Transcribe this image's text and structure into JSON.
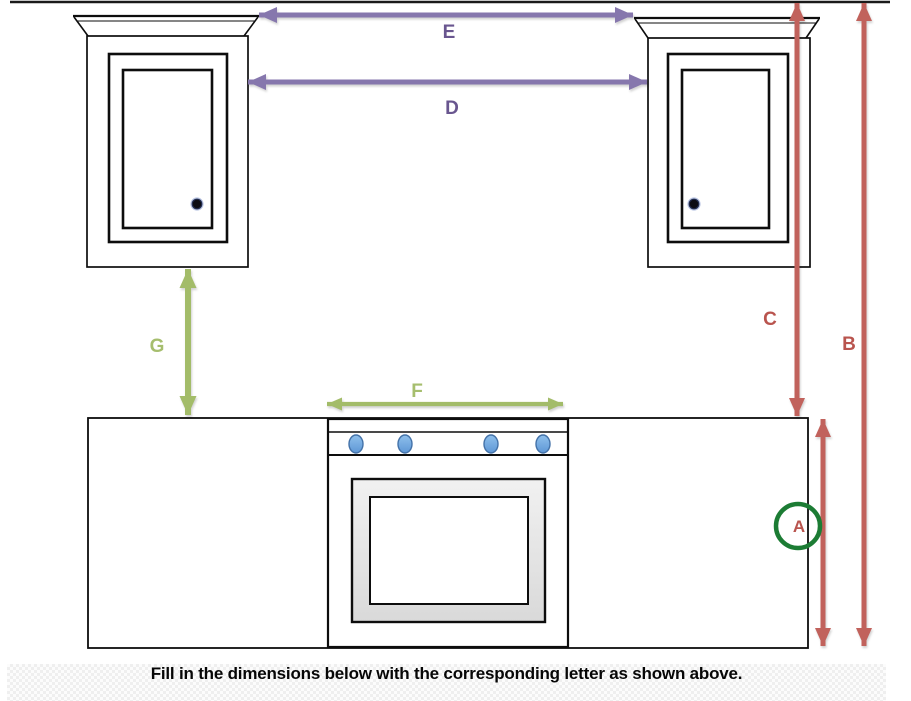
{
  "labels": {
    "a": "A",
    "b": "B",
    "c": "C",
    "d": "D",
    "e": "E",
    "f": "F",
    "g": "G"
  },
  "footer": {
    "instruction": "Fill in the dimensions below with the corresponding letter as shown above."
  },
  "colors": {
    "purple_arrow": "#8677AD",
    "purple_label": "#69568F",
    "red_arrow": "#C1625C",
    "red_label": "#B9544E",
    "green_arrow": "#A3BC69",
    "green_label": "#A6BE6E",
    "circle_green": "#1C7C34",
    "knob_blue": "#6FA8DC",
    "knob_blue_border": "#4472A8",
    "cabinet_outline": "#0D0D0D",
    "oven_door_gray": "#E6E6E6"
  }
}
